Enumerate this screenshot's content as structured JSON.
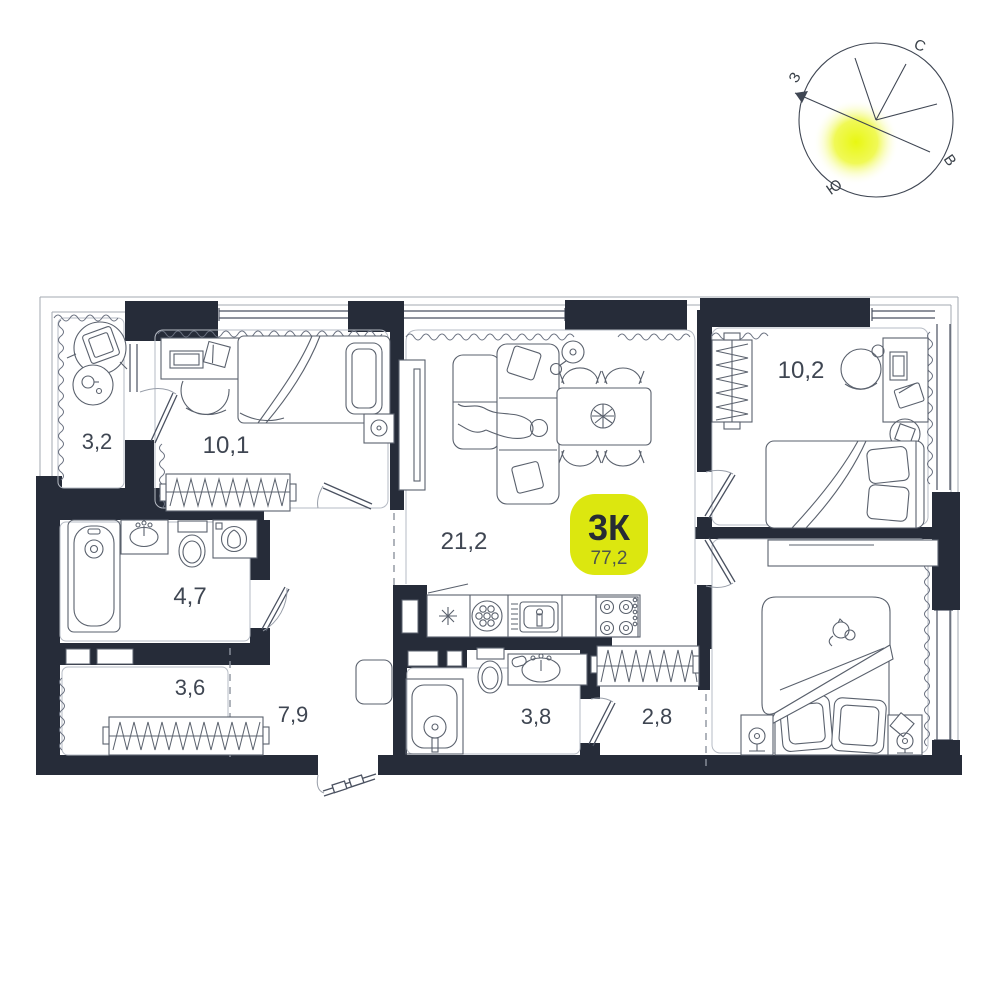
{
  "plan": {
    "unit_badge": {
      "type_label": "3К",
      "total_area": "77,2"
    },
    "rooms": {
      "balcony": "3,2",
      "bedroom1": "10,1",
      "living": "21,2",
      "bedroom2": "10,2",
      "bathroom": "4,7",
      "storage": "3,6",
      "hallway": "7,9",
      "shower": "3,8",
      "wardrobe": "2,8"
    },
    "compass": {
      "north": "С",
      "east": "В",
      "south": "Ю",
      "west": "З"
    },
    "colors": {
      "wall": "#262c39",
      "badge": "#dce70f",
      "glow": "#e8f607"
    }
  }
}
